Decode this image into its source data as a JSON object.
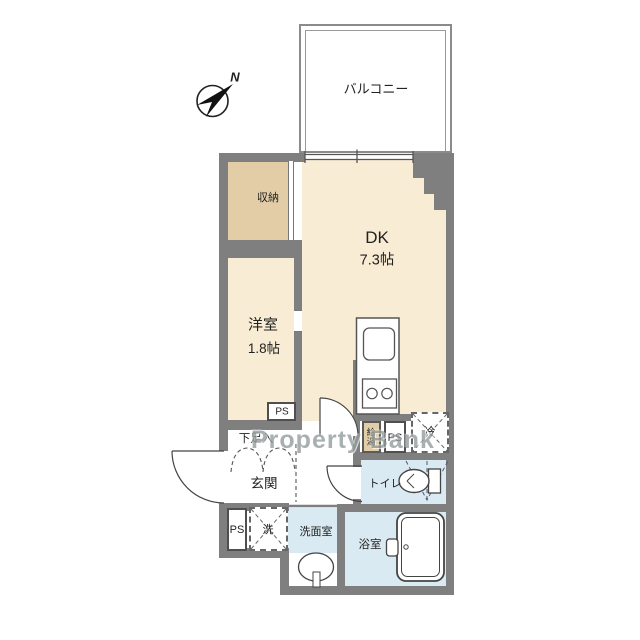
{
  "watermark": {
    "text": "Property Bank"
  },
  "compass": {
    "north_label": "N"
  },
  "rooms": {
    "balcony": {
      "label": "バルコニー"
    },
    "dk": {
      "label": "DK",
      "size": "7.3帖"
    },
    "storage": {
      "label": "収納"
    },
    "western_room": {
      "label": "洋室",
      "size": "1.8帖"
    },
    "entrance": {
      "label": "玄関"
    },
    "shoe_cabinet": {
      "label": "下足入"
    },
    "toilet": {
      "label": "トイレ"
    },
    "washroom": {
      "label": "洗面室"
    },
    "bathroom": {
      "label": "浴室"
    }
  },
  "fixtures": {
    "water_heater": {
      "label": "給湯"
    },
    "refrigerator_space": {
      "label": "冷"
    },
    "washer_space": {
      "label": "洗"
    }
  },
  "pipe_spaces": {
    "ps_west_room": {
      "label": "PS"
    },
    "ps_kitchen": {
      "label": "PS"
    },
    "ps_entrance": {
      "label": "PS"
    }
  },
  "colors": {
    "floor_cream": "#f8ecd4",
    "floor_tan": "#e3cda6",
    "floor_wet_blue": "#daeaf2",
    "wall_gray": "#7f7f7f",
    "watermark_gray": "#939d9d"
  }
}
